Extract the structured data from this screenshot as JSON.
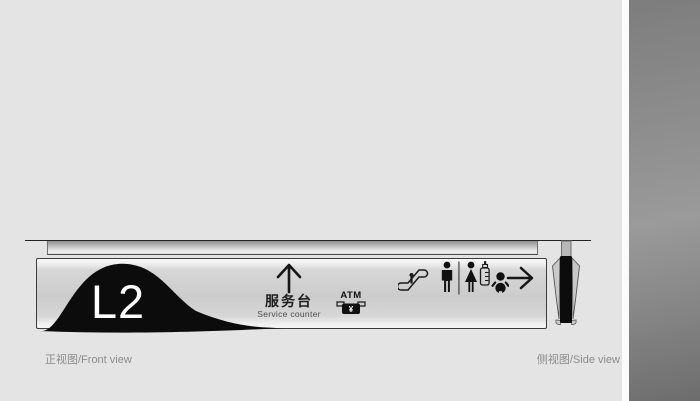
{
  "canvas": {
    "background": "#e4e4e4"
  },
  "sign": {
    "level": "L2",
    "destination_zh": "服务台",
    "destination_en": "Service counter",
    "atm": {
      "label": "ATM",
      "currency": "¥"
    },
    "icons": [
      "up-arrow-icon",
      "atm-machine-icon",
      "escalator-icon",
      "restroom-icon",
      "baby-care-icon",
      "right-arrow-icon"
    ]
  },
  "captions": {
    "front": "正视图/Front view",
    "side": "侧视图/Side view"
  },
  "colors": {
    "background": "#e4e4e4",
    "blob_black": "#0c0c0c",
    "panel_gray": "#cccccc",
    "caption_gray": "#8c8c8c",
    "strip_dark": "#8f8f8f"
  }
}
